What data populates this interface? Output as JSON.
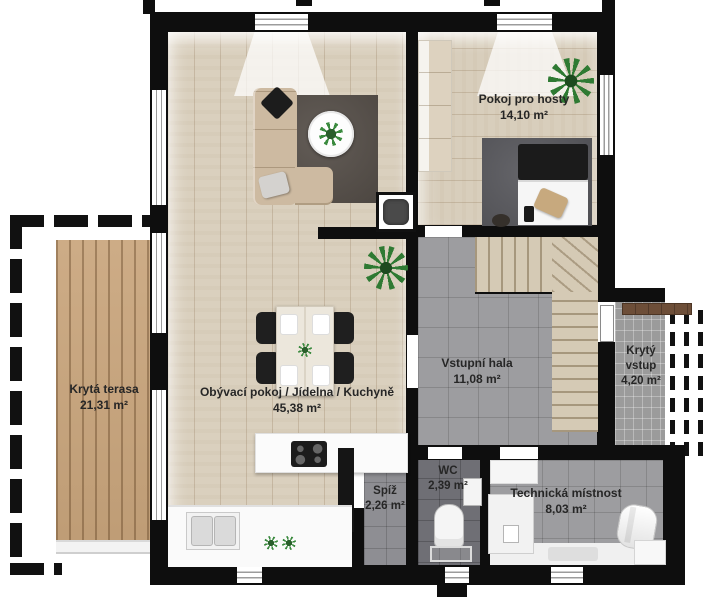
{
  "rooms": [
    {
      "name": "Obývací pokoj / Jídelna / Kuchyně",
      "area": "45,38 m²"
    },
    {
      "name": "Pokoj pro hosty",
      "area": "14,10 m²"
    },
    {
      "name": "Vstupní hala",
      "area": "11,08 m²"
    },
    {
      "name": "Krytá terasa",
      "area": "21,31 m²"
    },
    {
      "name": "Krytý vstup",
      "area": "4,20 m²"
    },
    {
      "name": "Spíž",
      "area": "2,26 m²"
    },
    {
      "name": "WC",
      "area": "2,39 m²"
    },
    {
      "name": "Technická místnost",
      "area": "8,03 m²"
    }
  ],
  "colors": {
    "wall": "#0e0e0e",
    "wood_floor": "#d9cfbd",
    "deck_wood": "#c9a57c",
    "tile_light": "#9d9da0",
    "tile_dark": "#6f6f75",
    "living_rug": "#57504a",
    "sofa": "#cdbaa1",
    "plant_green": "#2f7a33",
    "bench_wood": "#6d4e38",
    "label_text": "#262626"
  }
}
